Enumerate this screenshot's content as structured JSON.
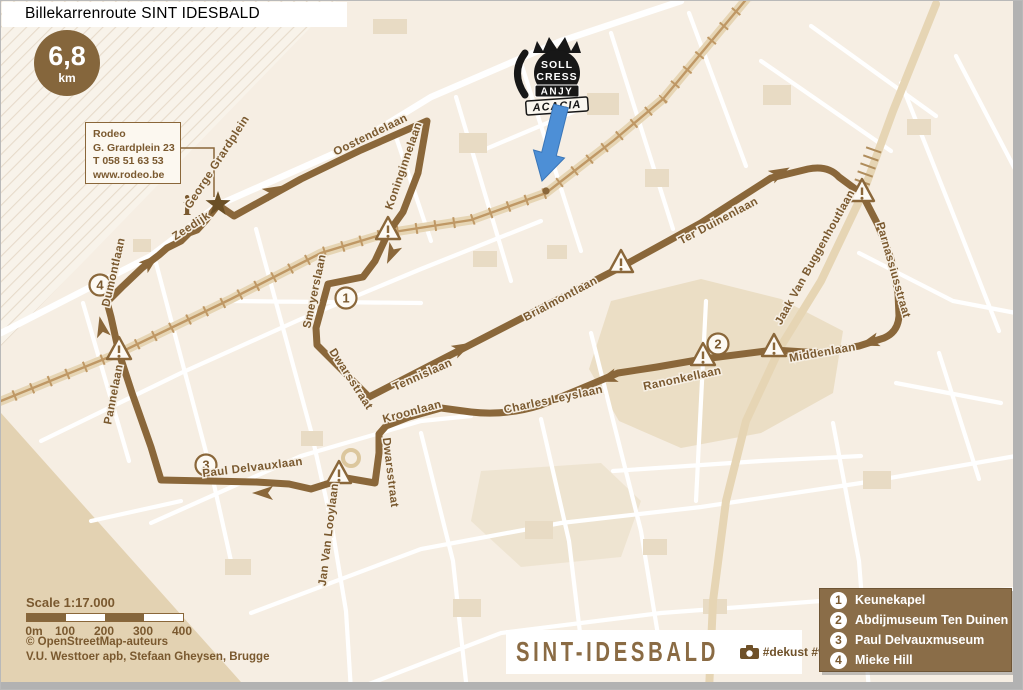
{
  "title": "Billekarrenroute SINT IDESBALD",
  "badge": {
    "distance": "6,8",
    "unit": "km"
  },
  "info_box": {
    "lines": [
      "Rodeo",
      "G. Grardplein 23",
      "T 058 51 63 53",
      "www.rodeo.be"
    ]
  },
  "info_symbol": "i",
  "emblem": {
    "lines": [
      "SOLL",
      "CRESS",
      "ANJY",
      "ACACIA"
    ]
  },
  "streets": [
    {
      "name": "George Grardplein"
    },
    {
      "name": "Oostendelaan"
    },
    {
      "name": "Koninginnelaan"
    },
    {
      "name": "Zeedijk"
    },
    {
      "name": "Dumontlaan"
    },
    {
      "name": "Pannelaan"
    },
    {
      "name": "Smeyerslaan"
    },
    {
      "name": "Dwarsstraat"
    },
    {
      "name": "Tennislaan"
    },
    {
      "name": "Kroonlaan"
    },
    {
      "name": "Brialmontlaan"
    },
    {
      "name": "Charles Leyslaan"
    },
    {
      "name": "Ranonkellaan"
    },
    {
      "name": "Ter Duinenlaan"
    },
    {
      "name": "Jaak Van Buggenhoutlaan"
    },
    {
      "name": "Parnassiusstraat"
    },
    {
      "name": "Middenlaan"
    },
    {
      "name": "Dwarsstraat"
    },
    {
      "name": "Paul Delvauxlaan"
    },
    {
      "name": "Jan Van Looylaan"
    }
  ],
  "pois": [
    {
      "number": "1",
      "label": "Keunekapel"
    },
    {
      "number": "2",
      "label": "Abdijmuseum Ten Duinen"
    },
    {
      "number": "3",
      "label": "Paul Delvauxmuseum"
    },
    {
      "number": "4",
      "label": "Mieke Hill"
    }
  ],
  "scale": {
    "label": "Scale 1:17.000",
    "ticks": [
      "0m",
      "100",
      "200",
      "300",
      "400"
    ]
  },
  "credits": {
    "line1": "© OpenStreetMap-auteurs",
    "line2": "V.U. Westtoer apb, Stefaan Gheysen, Brugge"
  },
  "footer": {
    "brand": "SINT-IDESBALD",
    "hashtags": "#dekust #visitkoksijde"
  },
  "colors": {
    "route_brown": "#8a673a",
    "label_brown": "#7a592f",
    "legend_bg": "#8a6d48",
    "tram": "#bf9865",
    "arrow_blue": "#4d8fd6",
    "sand": "#e3d2b2"
  }
}
